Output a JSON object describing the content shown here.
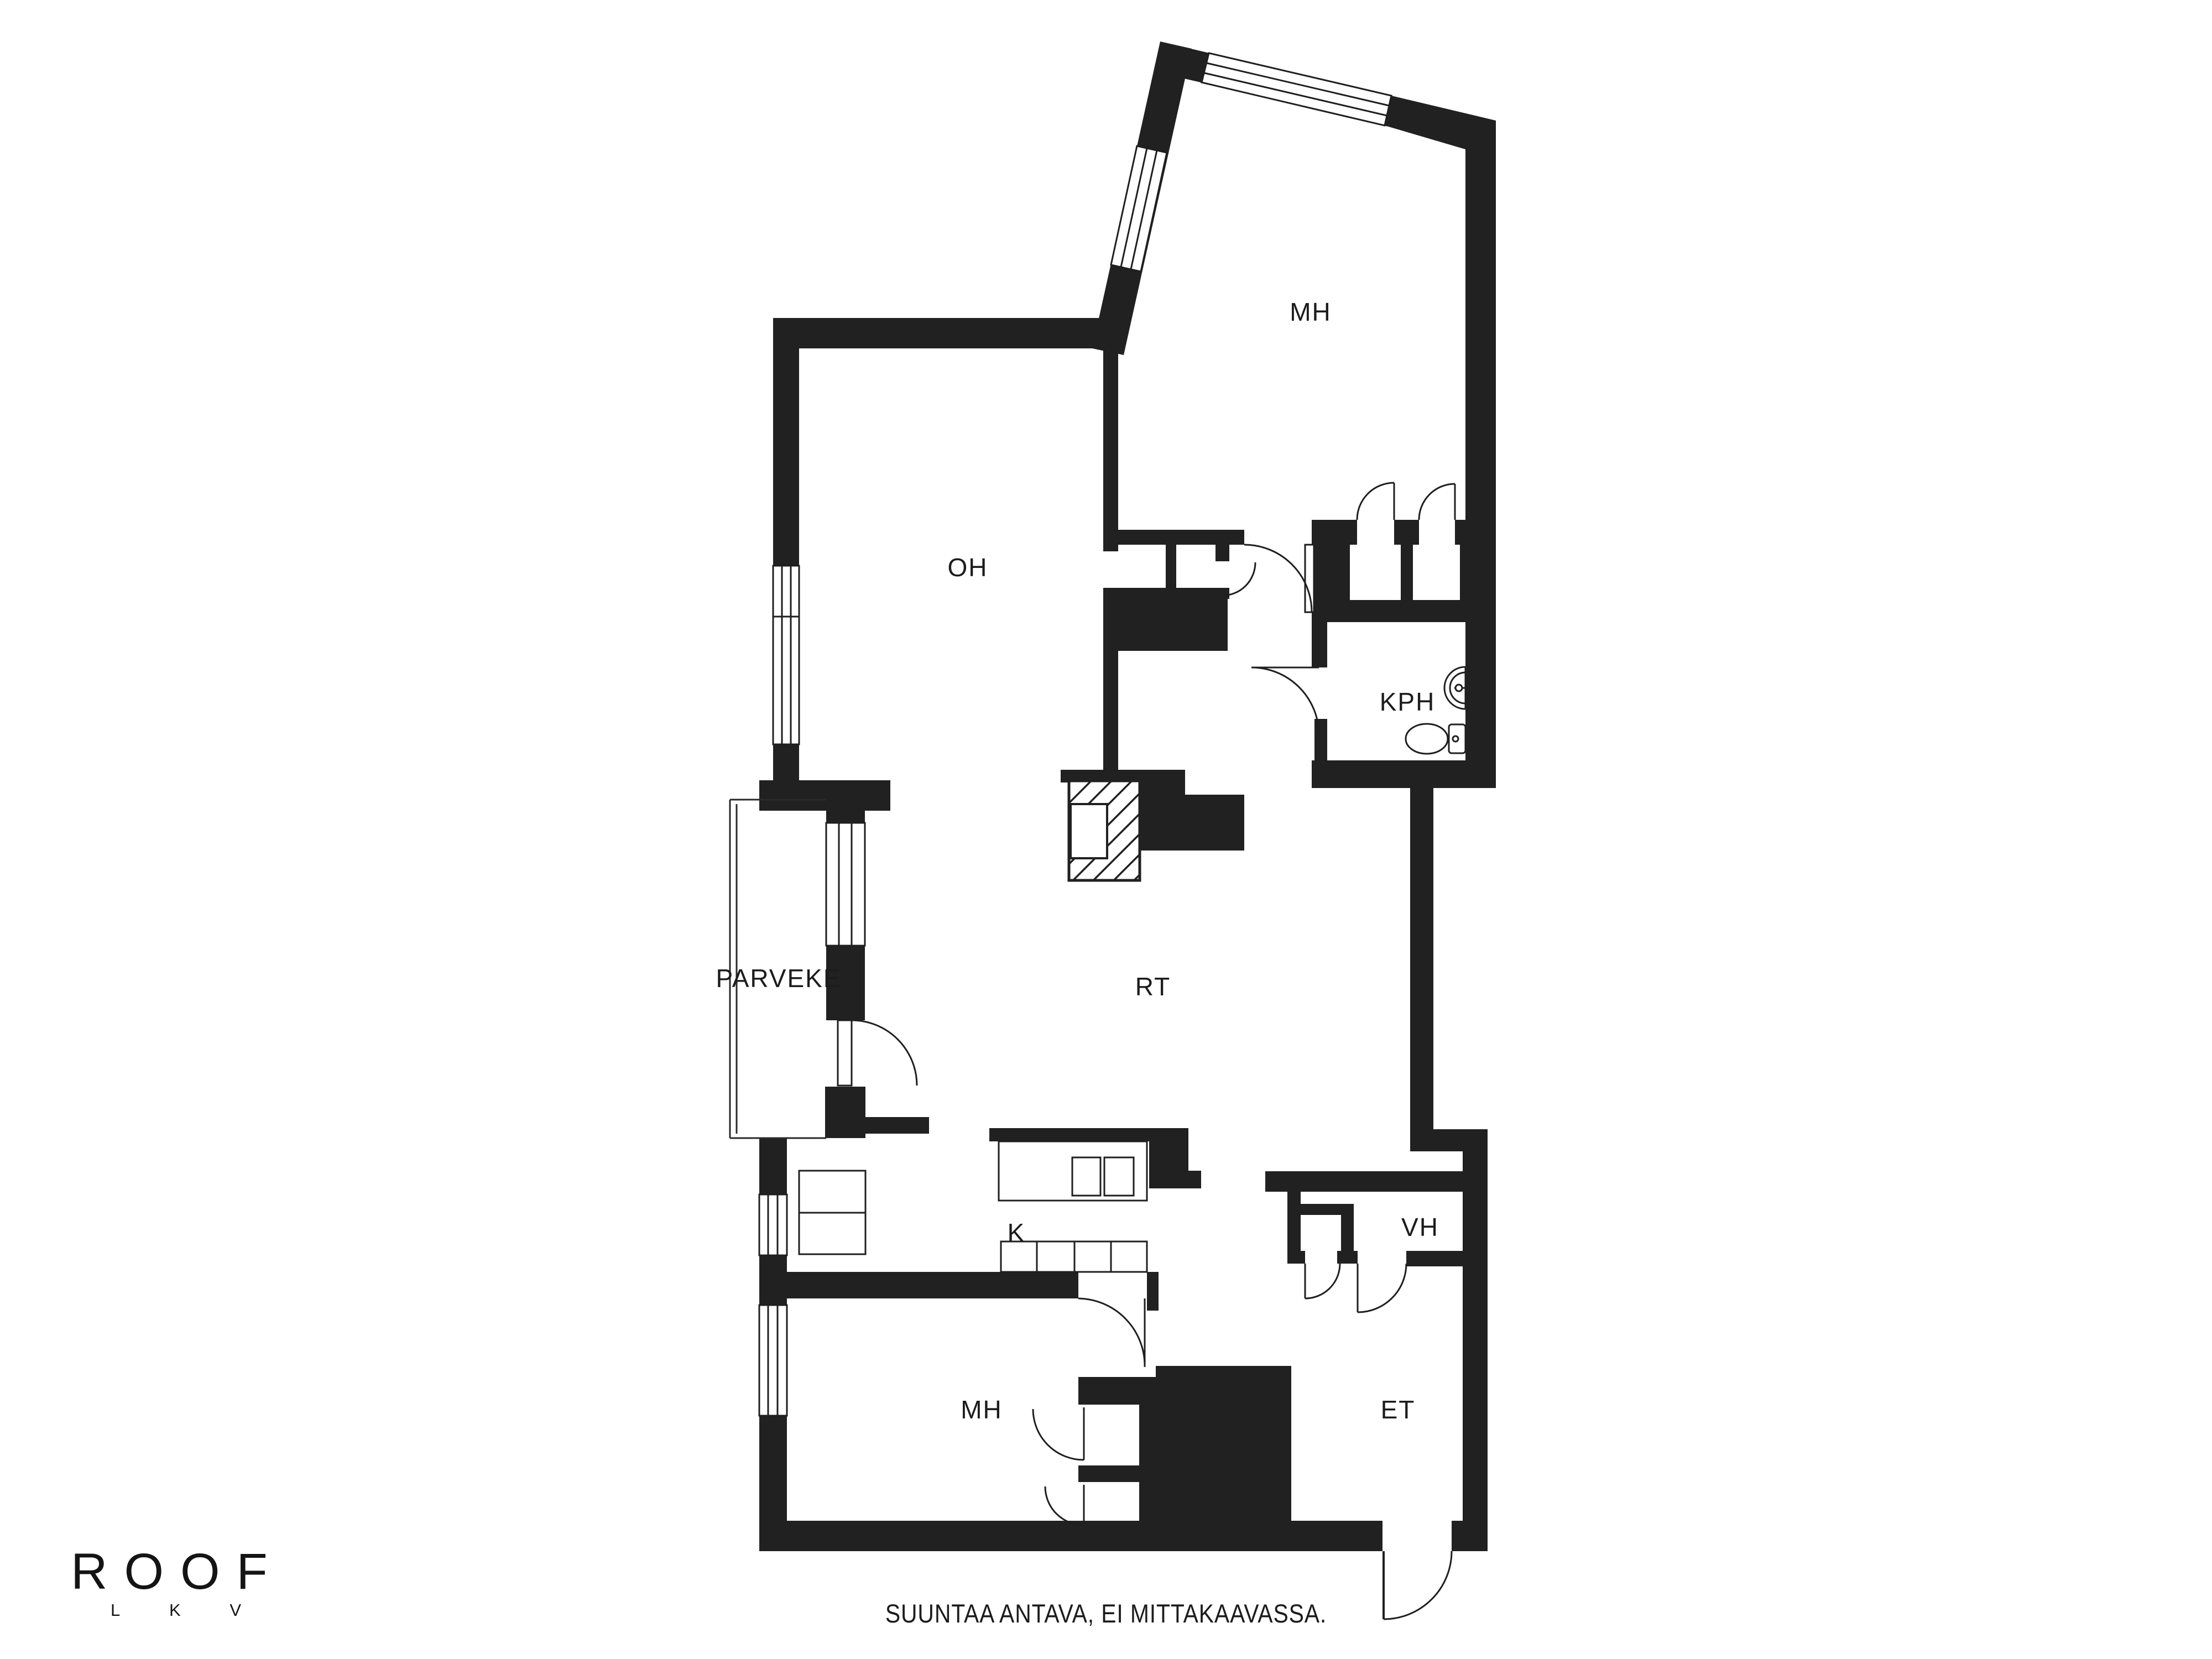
{
  "floor_plan": {
    "rooms": [
      {
        "id": "mh-top",
        "label": "MH"
      },
      {
        "id": "oh",
        "label": "OH"
      },
      {
        "id": "kph",
        "label": "KPH"
      },
      {
        "id": "parveke",
        "label": "PARVEKE"
      },
      {
        "id": "rt",
        "label": "RT"
      },
      {
        "id": "k",
        "label": "K"
      },
      {
        "id": "vh",
        "label": "VH"
      },
      {
        "id": "mh-bottom",
        "label": "MH"
      },
      {
        "id": "et",
        "label": "ET"
      }
    ],
    "fixtures": [
      "fireplace-flue",
      "kitchen-island-counter",
      "kitchen-counter",
      "wall-counter",
      "sink",
      "toilet"
    ]
  },
  "logo": {
    "brand": "ROOF",
    "sub_letters": [
      "L",
      "K",
      "V"
    ]
  },
  "footer": {
    "disclaimer": "SUUNTAA ANTAVA, EI MITTAKAAVASSA."
  },
  "colors": {
    "walls": "#212121",
    "lines": "#1f1f1f",
    "background": "#ffffff",
    "text": "#1c1c1c"
  }
}
